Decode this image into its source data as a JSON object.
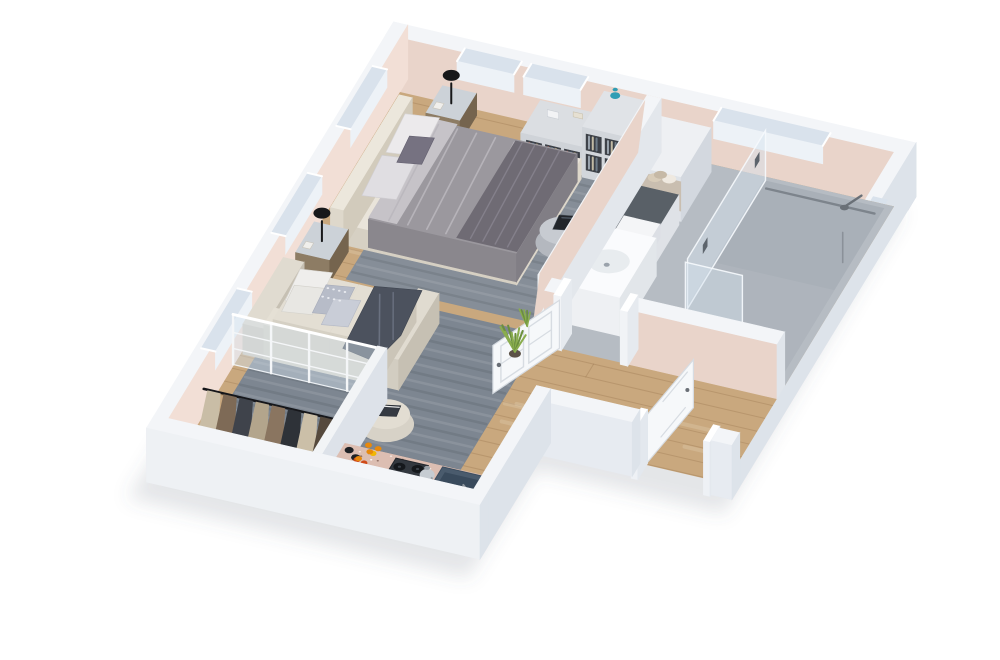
{
  "scene": {
    "type": "isometric-3d-floor-plan-render",
    "items": [
      "bed",
      "headboard",
      "pillows",
      "duvet",
      "nightstand-left",
      "nightstand-right",
      "table-lamp",
      "bench-pouf",
      "bed-rug",
      "living-rug",
      "sofa",
      "throw-blanket",
      "ottoman",
      "book",
      "wardrobe-rail",
      "hanging-clothes",
      "glass-partition",
      "shelving-unit",
      "cube-shelf",
      "vase",
      "kitchen-counter",
      "gas-stove",
      "kettle",
      "kitchen-sink",
      "fruit-crate",
      "jars",
      "bathroom",
      "shower",
      "shower-glass",
      "shower-head",
      "bathroom-sink",
      "sink-cabinet",
      "towel-shelf",
      "laundry-counter",
      "bathroom-door",
      "entry-door",
      "plant",
      "windows"
    ]
  },
  "palette": {
    "bg": "#ffffff",
    "shadow": "rgba(84,94,114,0.16)",
    "wallTop": "#f3f5f8",
    "wallOuter": "#e7ebf1",
    "wallOuterDark": "#cdd5de",
    "wallOuterMid": "#dde3ea",
    "wallPink": "#e9d4ca",
    "wallPinkLight": "#f2dfd6",
    "windowGlass": "#d9e2ec",
    "windowFace": "#edf2f7",
    "wood": "#c9a87e",
    "woodLine": "rgba(122,88,50,0.22)",
    "woodLight": "rgba(255,248,235,0.20)",
    "bathFloor": "#b6bcc3",
    "showerFloor": "#a9b0b8",
    "drain": "#7d848c",
    "rug": "#7d8691",
    "rugBed": "#868e98",
    "rugLight": "rgba(255,255,255,0.10)",
    "rugDark": "rgba(20,26,34,0.10)",
    "cream": "#e9e4da",
    "creamDark": "#d6d0c3",
    "creamSide": "#ddd7ca",
    "duvet": "#9b989e",
    "duvetFold": "#bab7bd",
    "sheet": "#c6c3c8",
    "pillowWhite": "#eceaec",
    "pillowGrey": "#e0dee2",
    "pillowDark": "#767281",
    "footThrow": "#6f6b74",
    "pouf": "#b4b8bf",
    "poufTop": "#c7cbd1",
    "tray": "#22262b",
    "sofaBase": "#d9d4c9",
    "sofaCushion": "#e5e0d5",
    "sofaFront": "#cbc6ba",
    "pillowPattern": "#b7bcc8",
    "pillowPattern2": "#c9cdd7",
    "jacket": "#4c525e",
    "nsBody": "#8d7c64",
    "nsSide": "#75644e",
    "nsTop": "#ccd2d8",
    "lamp": "#17181a",
    "shelf": "#dbdee2",
    "shelfSide": "#c6cbd1",
    "cubby": "#3c4047",
    "vase": "#2f9db4",
    "counterTop": "#dcbeb2",
    "counterSide": "#c9a89c",
    "stove": "#33383f",
    "burner": "#15181c",
    "kettle": "#c6ccd2",
    "sinkNavy": "#4a5b6d",
    "sinkNavyDeep": "#394a5c",
    "crate": "#a5683a",
    "fruitOrange": "#e8890c",
    "fruitYellow": "#f2b705",
    "fruitRed": "#cf4a18",
    "jar": "#1e2125",
    "towel1": "#d8ccb9",
    "towel2": "#efe9e0",
    "towel3": "#c6b9a6",
    "bathCounter": "#596067",
    "basketWhite": "#f4f5f7",
    "oak": "#c09055",
    "oakDark": "#a87a44",
    "basin": "#fafbfd",
    "basinInner": "#e8ecef",
    "glass": "rgba(213,227,238,0.45)",
    "glassEdge": "rgba(246,250,253,0.9)",
    "metal": "#8d959d",
    "doorWhite": "#f6f8fa",
    "doorEdge": "#d7dce2",
    "plantGreen": "#6b8f3d",
    "plantGreen2": "#8aad4e",
    "pot": "#5c5247",
    "railBlack": "#15161a",
    "clothes": [
      "#c9bda6",
      "#7e6a56",
      "#3f434b",
      "#b3a58c",
      "#8a7560",
      "#2e3238",
      "#cbbfa8",
      "#55493d"
    ],
    "shoe": "#2c2f35",
    "bookDark": "#353a42"
  }
}
